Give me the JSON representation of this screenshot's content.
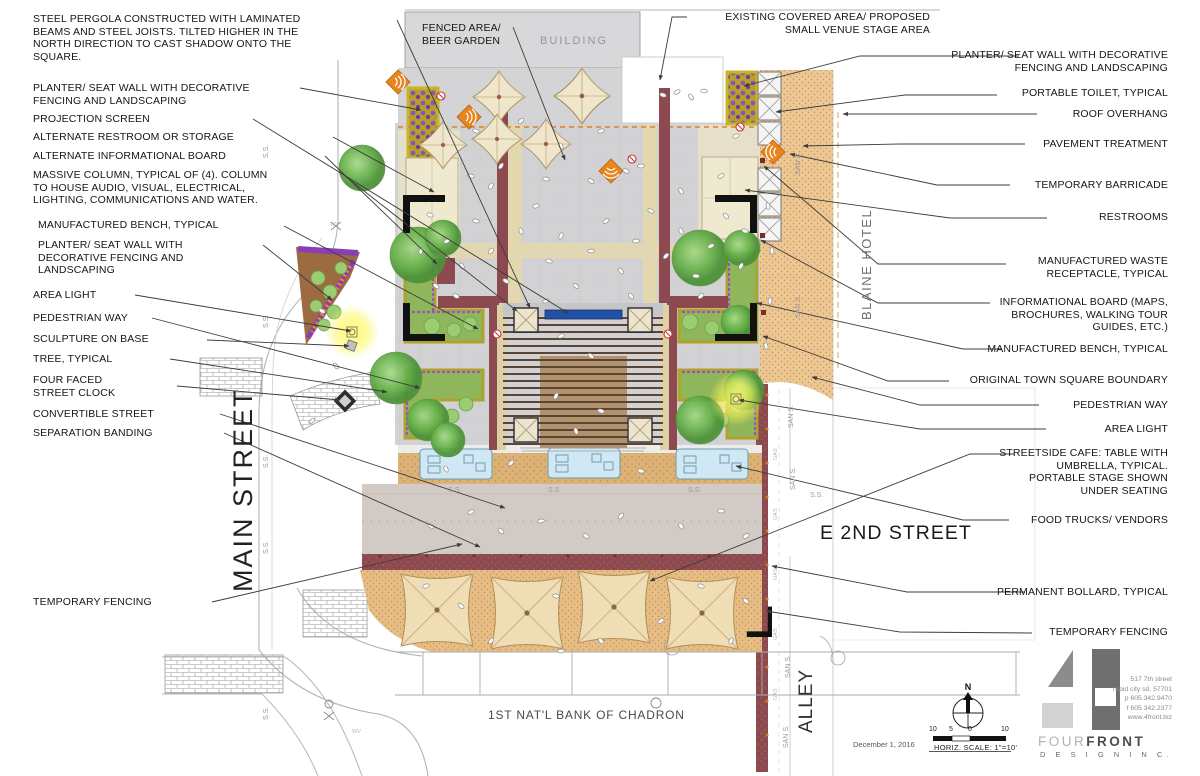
{
  "plan_labels": {
    "building": "BUILDING",
    "fenced_area": "FENCED AREA/\nBEER GARDEN",
    "existing_covered": "EXISTING COVERED AREA/ PROPOSED\nSMALL VENUE STAGE AREA"
  },
  "left_callouts": [
    {
      "id": "steel-pergola",
      "text": "STEEL PERGOLA CONSTRUCTED WITH LAMINATED\nBEAMS AND STEEL JOISTS. TILTED HIGHER IN THE\nNORTH DIRECTION TO CAST SHADOW ONTO THE\nSQUARE."
    },
    {
      "id": "planter-seat-wall-top",
      "text": "PLANTER/ SEAT WALL WITH DECORATIVE\nFENCING AND LANDSCAPING"
    },
    {
      "id": "projection-screen",
      "text": "PROJECTION SCREEN"
    },
    {
      "id": "alternate-restroom",
      "text": "ALTERNATE RESTROOM OR STORAGE"
    },
    {
      "id": "alternate-info-board",
      "text": "ALTERNATE INFORMATIONAL BOARD"
    },
    {
      "id": "massive-column",
      "text": "MASSIVE COLUMN, TYPICAL OF (4). COLUMN\nTO HOUSE AUDIO, VISUAL, ELECTRICAL,\nLIGHTING, COMMUNICATIONS AND WATER."
    },
    {
      "id": "manufactured-bench",
      "text": "MANUFACTURED BENCH, TYPICAL"
    },
    {
      "id": "planter-seat-wall-mid",
      "text": "PLANTER/ SEAT WALL WITH\nDECORATIVE FENCING AND\nLANDSCAPING"
    },
    {
      "id": "area-light",
      "text": "AREA LIGHT"
    },
    {
      "id": "pedestrian-way",
      "text": "PEDESTRIAN WAY"
    },
    {
      "id": "sculpture-on-base",
      "text": "SCULPTURE ON BASE"
    },
    {
      "id": "tree-typical",
      "text": "TREE, TYPICAL"
    },
    {
      "id": "four-faced-street-clock",
      "text": "FOUR FACED\nSTREET CLOCK"
    },
    {
      "id": "convertible-street",
      "text": "CONVERTIBLE STREET"
    },
    {
      "id": "separation-banding",
      "text": "SEPARATION BANDING"
    },
    {
      "id": "temporary-fencing-left",
      "text": "TEMPORARY FENCING"
    }
  ],
  "right_callouts": [
    {
      "id": "planter-seat-wall-right",
      "text": "PLANTER/ SEAT WALL WITH DECORATIVE\nFENCING AND LANDSCAPING"
    },
    {
      "id": "portable-toilet",
      "text": "PORTABLE TOILET, TYPICAL"
    },
    {
      "id": "roof-overhang",
      "text": "ROOF OVERHANG"
    },
    {
      "id": "pavement-treatment",
      "text": "PAVEMENT TREATMENT"
    },
    {
      "id": "temporary-barricade",
      "text": "TEMPORARY BARRICADE"
    },
    {
      "id": "restrooms",
      "text": "RESTROOMS"
    },
    {
      "id": "waste-receptacle",
      "text": "MANUFACTURED WASTE\nRECEPTACLE, TYPICAL"
    },
    {
      "id": "informational-board",
      "text": "INFORMATIONAL BOARD (MAPS,\nBROCHURES, WALKING TOUR\nGUIDES, ETC.)"
    },
    {
      "id": "manufactured-bench-right",
      "text": "MANUFACTURED BENCH, TYPICAL"
    },
    {
      "id": "original-boundary",
      "text": "ORIGINAL TOWN SQUARE BOUNDARY"
    },
    {
      "id": "pedestrian-way-right",
      "text": "PEDESTRIAN WAY"
    },
    {
      "id": "area-light-right",
      "text": "AREA LIGHT"
    },
    {
      "id": "streetside-cafe",
      "text": "STREETSIDE CAFE: TABLE WITH\nUMBRELLA, TYPICAL.\nPORTABLE STAGE SHOWN\nUNDER SEATING"
    },
    {
      "id": "food-trucks",
      "text": "FOOD TRUCKS/ VENDORS"
    },
    {
      "id": "permanent-bollard",
      "text": "PERMANENT BOLLARD, TYPICAL"
    },
    {
      "id": "temporary-fencing-right",
      "text": "TEMPORARY FENCING"
    }
  ],
  "street_labels": {
    "main_street": "MAIN STREET",
    "e_2nd_street": "E 2ND STREET",
    "blaine_hotel": "BLAINE HOTEL",
    "alley": "ALLEY",
    "bank": "1ST NAT'L BANK OF CHADRON"
  },
  "utility_labels": {
    "ss": "S.S.",
    "san_s": "SAN S.",
    "gas": "GAS",
    "wv": "WV"
  },
  "titleblock": {
    "date": "December 1, 2016",
    "scale_label": "HORIZ. SCALE: 1\"=10'",
    "scale_ticks": [
      "10",
      "5",
      "0",
      "10"
    ],
    "north_letter": "N",
    "logo_four": "FOUR",
    "logo_front": "FRONT",
    "logo_design": "D E S I G N   I N C.",
    "address": "517 7th street\nrapid city sd. 57701\np 605.342.9470\nf 605.342.2377\nwww.4front.biz"
  },
  "colors": {
    "maroon_wall": "#8c4a50",
    "orange_pavement": "#ecc793",
    "plaza_gray": "#d2d2d4",
    "tan_band": "#e2d7ae",
    "screen_blue": "#2250a4",
    "speaker_orange": "#e8851c",
    "planter_purple": "#8a4fc8",
    "tree_green": "#66b14a",
    "glow_yellow": "#fff75e"
  }
}
